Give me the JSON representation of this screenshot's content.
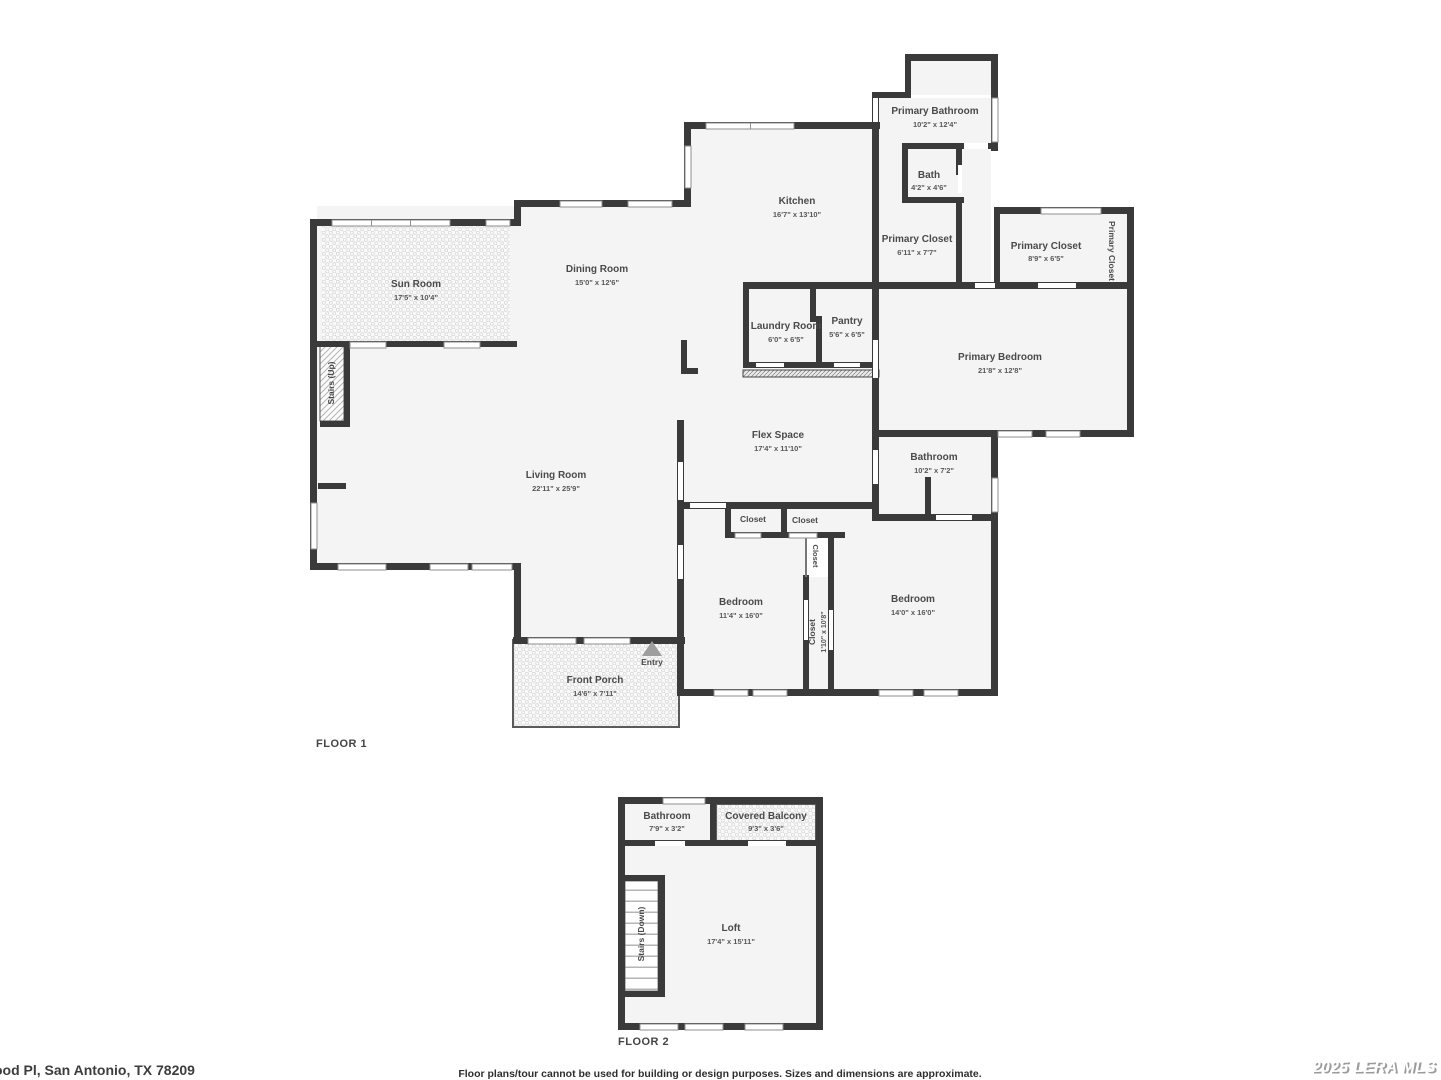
{
  "floor1": {
    "label": "FLOOR 1",
    "rooms": {
      "sun_room": {
        "name": "Sun Room",
        "dims": "17'5\" x 10'4\""
      },
      "dining_room": {
        "name": "Dining Room",
        "dims": "15'0\" x 12'6\""
      },
      "kitchen": {
        "name": "Kitchen",
        "dims": "16'7\" x 13'10\""
      },
      "primary_bathroom": {
        "name": "Primary Bathroom",
        "dims": "10'2\" x 12'4\""
      },
      "bath": {
        "name": "Bath",
        "dims": "4'2\" x 4'6\""
      },
      "primary_closet_1": {
        "name": "Primary Closet",
        "dims": "6'11\" x 7'7\""
      },
      "primary_closet_2": {
        "name": "Primary Closet",
        "dims": "8'9\" x 6'5\""
      },
      "primary_closet_3": {
        "name": "Primary Closet"
      },
      "primary_bedroom": {
        "name": "Primary Bedroom",
        "dims": "21'8\" x 12'8\""
      },
      "laundry_room": {
        "name": "Laundry Room",
        "dims": "6'0\" x 6'5\""
      },
      "pantry": {
        "name": "Pantry",
        "dims": "5'6\" x 6'5\""
      },
      "flex_space": {
        "name": "Flex Space",
        "dims": "17'4\" x 11'10\""
      },
      "bathroom": {
        "name": "Bathroom",
        "dims": "10'2\" x 7'2\""
      },
      "living_room": {
        "name": "Living Room",
        "dims": "22'11\" x 25'9\""
      },
      "stairs_up": {
        "name": "Stairs (Up)"
      },
      "closet_a": {
        "name": "Closet"
      },
      "closet_b": {
        "name": "Closet"
      },
      "closet_c": {
        "name": "Closet"
      },
      "closet_d": {
        "name": "Closet",
        "dims": "1'10\" x 10'8\""
      },
      "bedroom_1": {
        "name": "Bedroom",
        "dims": "11'4\" x 16'0\""
      },
      "bedroom_2": {
        "name": "Bedroom",
        "dims": "14'0\" x 16'0\""
      },
      "entry": {
        "name": "Entry"
      },
      "front_porch": {
        "name": "Front Porch",
        "dims": "14'6\" x 7'11\""
      }
    }
  },
  "floor2": {
    "label": "FLOOR 2",
    "rooms": {
      "bathroom": {
        "name": "Bathroom",
        "dims": "7'9\" x 3'2\""
      },
      "covered_balcony": {
        "name": "Covered Balcony",
        "dims": "9'3\" x 3'6\""
      },
      "loft": {
        "name": "Loft",
        "dims": "17'4\" x 15'11\""
      },
      "stairs_down": {
        "name": "Stairs (Down)"
      }
    }
  },
  "footer": {
    "address": "ood Pl, San Antonio, TX 78209",
    "disclaimer": "Floor plans/tour cannot be used for building or design purposes. Sizes and dimensions are approximate.",
    "watermark": "2025 LERA MLS"
  },
  "colors": {
    "wall": "#3a3a3a",
    "room_fill": "#f4f4f4",
    "label": "#4a4a4a",
    "background": "#ffffff"
  }
}
